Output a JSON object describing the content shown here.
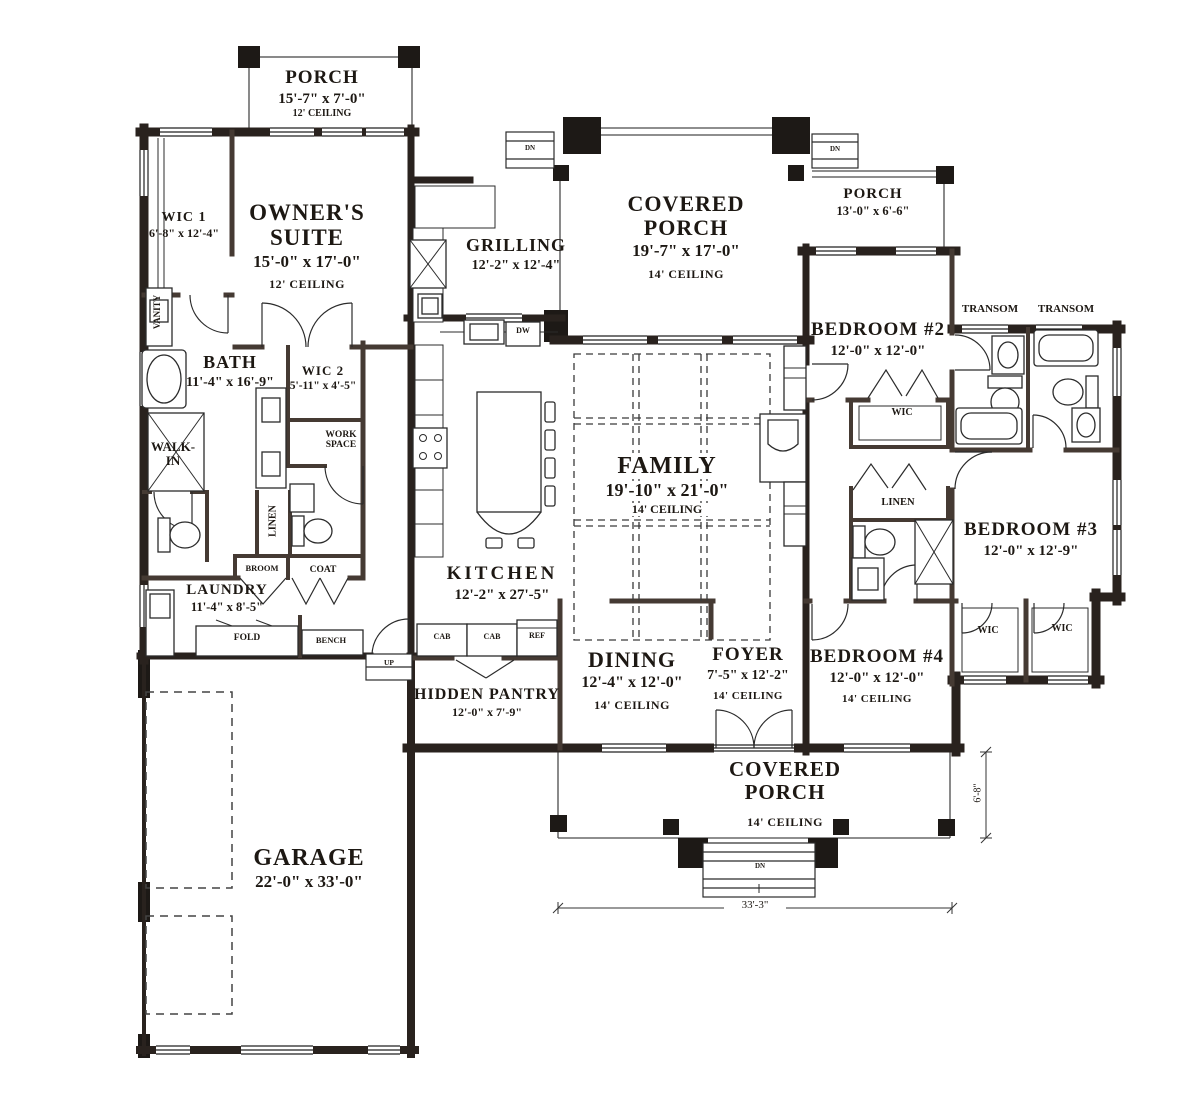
{
  "title": "Single-story house floor plan",
  "rooms": {
    "porch_tl": {
      "name": "PORCH",
      "dims": "15'-7\" x 7'-0\"",
      "ceiling": "12' CEILING"
    },
    "owners_suite": {
      "name": "OWNER'S SUITE",
      "dims": "15'-0\" x 17'-0\"",
      "ceiling": "12' CEILING"
    },
    "wic1": {
      "name": "WIC 1",
      "dims": "6'-8\" x 12'-4\""
    },
    "bath": {
      "name": "BATH",
      "dims": "11'-4\" x 16'-9\""
    },
    "wic2": {
      "name": "WIC 2",
      "dims": "5'-11\" x 4'-5\""
    },
    "grilling": {
      "name": "GRILLING",
      "dims": "12'-2\" x 12'-4\""
    },
    "covered_porch_top": {
      "name": "COVERED PORCH",
      "dims": "19'-7\" x 17'-0\"",
      "ceiling": "14' CEILING"
    },
    "porch_tr": {
      "name": "PORCH",
      "dims": "13'-0\" x 6'-6\""
    },
    "bedroom2": {
      "name": "BEDROOM #2",
      "dims": "12'-0\" x 12'-0\""
    },
    "family": {
      "name": "FAMILY",
      "dims": "19'-10\" x 21'-0\"",
      "ceiling": "14' CEILING"
    },
    "kitchen": {
      "name": "KITCHEN",
      "dims": "12'-2\" x 27'-5\""
    },
    "bedroom3": {
      "name": "BEDROOM #3",
      "dims": "12'-0\" x 12'-9\""
    },
    "laundry": {
      "name": "LAUNDRY",
      "dims": "11'-4\" x 8'-5\""
    },
    "hidden_pantry": {
      "name": "HIDDEN PANTRY",
      "dims": "12'-0\" x 7'-9\""
    },
    "dining": {
      "name": "DINING",
      "dims": "12'-4\" x 12'-0\"",
      "ceiling": "14' CEILING"
    },
    "foyer": {
      "name": "FOYER",
      "dims": "7'-5\" x 12'-2\"",
      "ceiling": "14' CEILING"
    },
    "bedroom4": {
      "name": "BEDROOM #4",
      "dims": "12'-0\" x 12'-0\"",
      "ceiling": "14' CEILING"
    },
    "covered_porch_bottom": {
      "name": "COVERED PORCH",
      "ceiling": "14' CEILING"
    },
    "garage": {
      "name": "GARAGE",
      "dims": "22'-0\" x 33'-0\""
    }
  },
  "closets": {
    "wic_bedroom2": "WIC",
    "linen_hall": "LINEN",
    "wic_b3_left": "WIC",
    "wic_b3_right": "WIC",
    "walk_in_line1": "WALK-",
    "walk_in_line2": "IN",
    "linen_owners": "LINEN",
    "vanity": "VANITY",
    "broom": "BROOM",
    "coat": "COAT",
    "work_space_line1": "WORK",
    "work_space_line2": "SPACE"
  },
  "fixtures": {
    "fold": "FOLD",
    "bench": "BENCH",
    "cab1": "CAB",
    "cab2": "CAB",
    "ref": "REF",
    "dw": "DW"
  },
  "stairs": {
    "up": "UP",
    "dn_top_left": "DN",
    "dn_top_right": "DN",
    "dn_bottom": "DN"
  },
  "windows": {
    "transom_left": "TRANSOM",
    "transom_right": "TRANSOM"
  },
  "dimensions": {
    "overall_width": "33'-3\"",
    "porch_depth": "6'-8\""
  },
  "colors": {
    "wall": "#29221e",
    "interior_wall": "#453a33",
    "line": "#2b2b2b",
    "text": "#1d1813"
  }
}
